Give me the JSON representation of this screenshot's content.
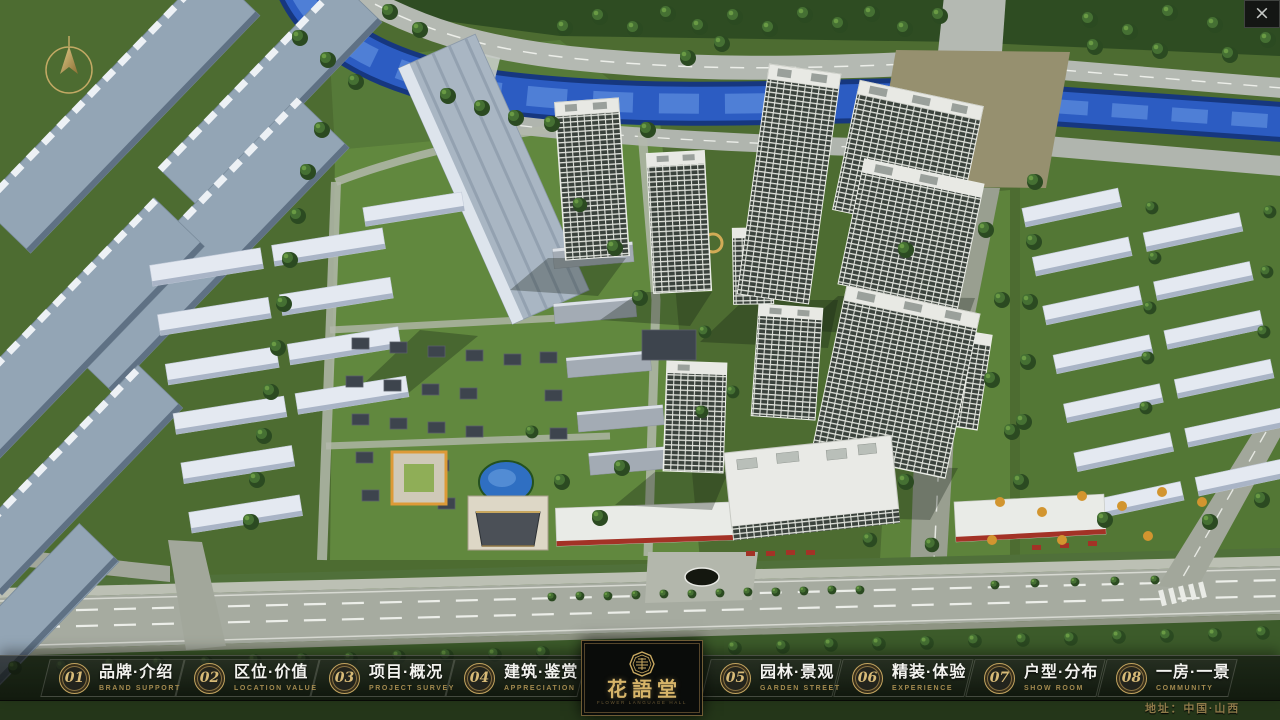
{
  "window": {
    "close_glyph": "×"
  },
  "nav": {
    "items": [
      {
        "num": "01",
        "label": "品牌·介绍",
        "sublabel": "BRAND SUPPORT"
      },
      {
        "num": "02",
        "label": "区位·价值",
        "sublabel": "LOCATION VALUE"
      },
      {
        "num": "03",
        "label": "项目·概况",
        "sublabel": "PROJECT SURVEY"
      },
      {
        "num": "04",
        "label": "建筑·鉴赏",
        "sublabel": "APPRECIATION"
      },
      {
        "num": "05",
        "label": "园林·景观",
        "sublabel": "GARDEN STREET"
      },
      {
        "num": "06",
        "label": "精装·体验",
        "sublabel": "EXPERIENCE"
      },
      {
        "num": "07",
        "label": "户型·分布",
        "sublabel": "SHOW ROOM"
      },
      {
        "num": "08",
        "label": "一房·一景",
        "sublabel": "COMMUNITY"
      }
    ]
  },
  "logo": {
    "brand": "花語堂",
    "caption": "FLOWER LANGUAGE HALL"
  },
  "footer": {
    "address": "地址：中国·山西"
  },
  "colors": {
    "gold": "#c9a961",
    "gold_dim": "#9a8350",
    "bar_bg": "rgba(10,12,10,0.7)"
  }
}
